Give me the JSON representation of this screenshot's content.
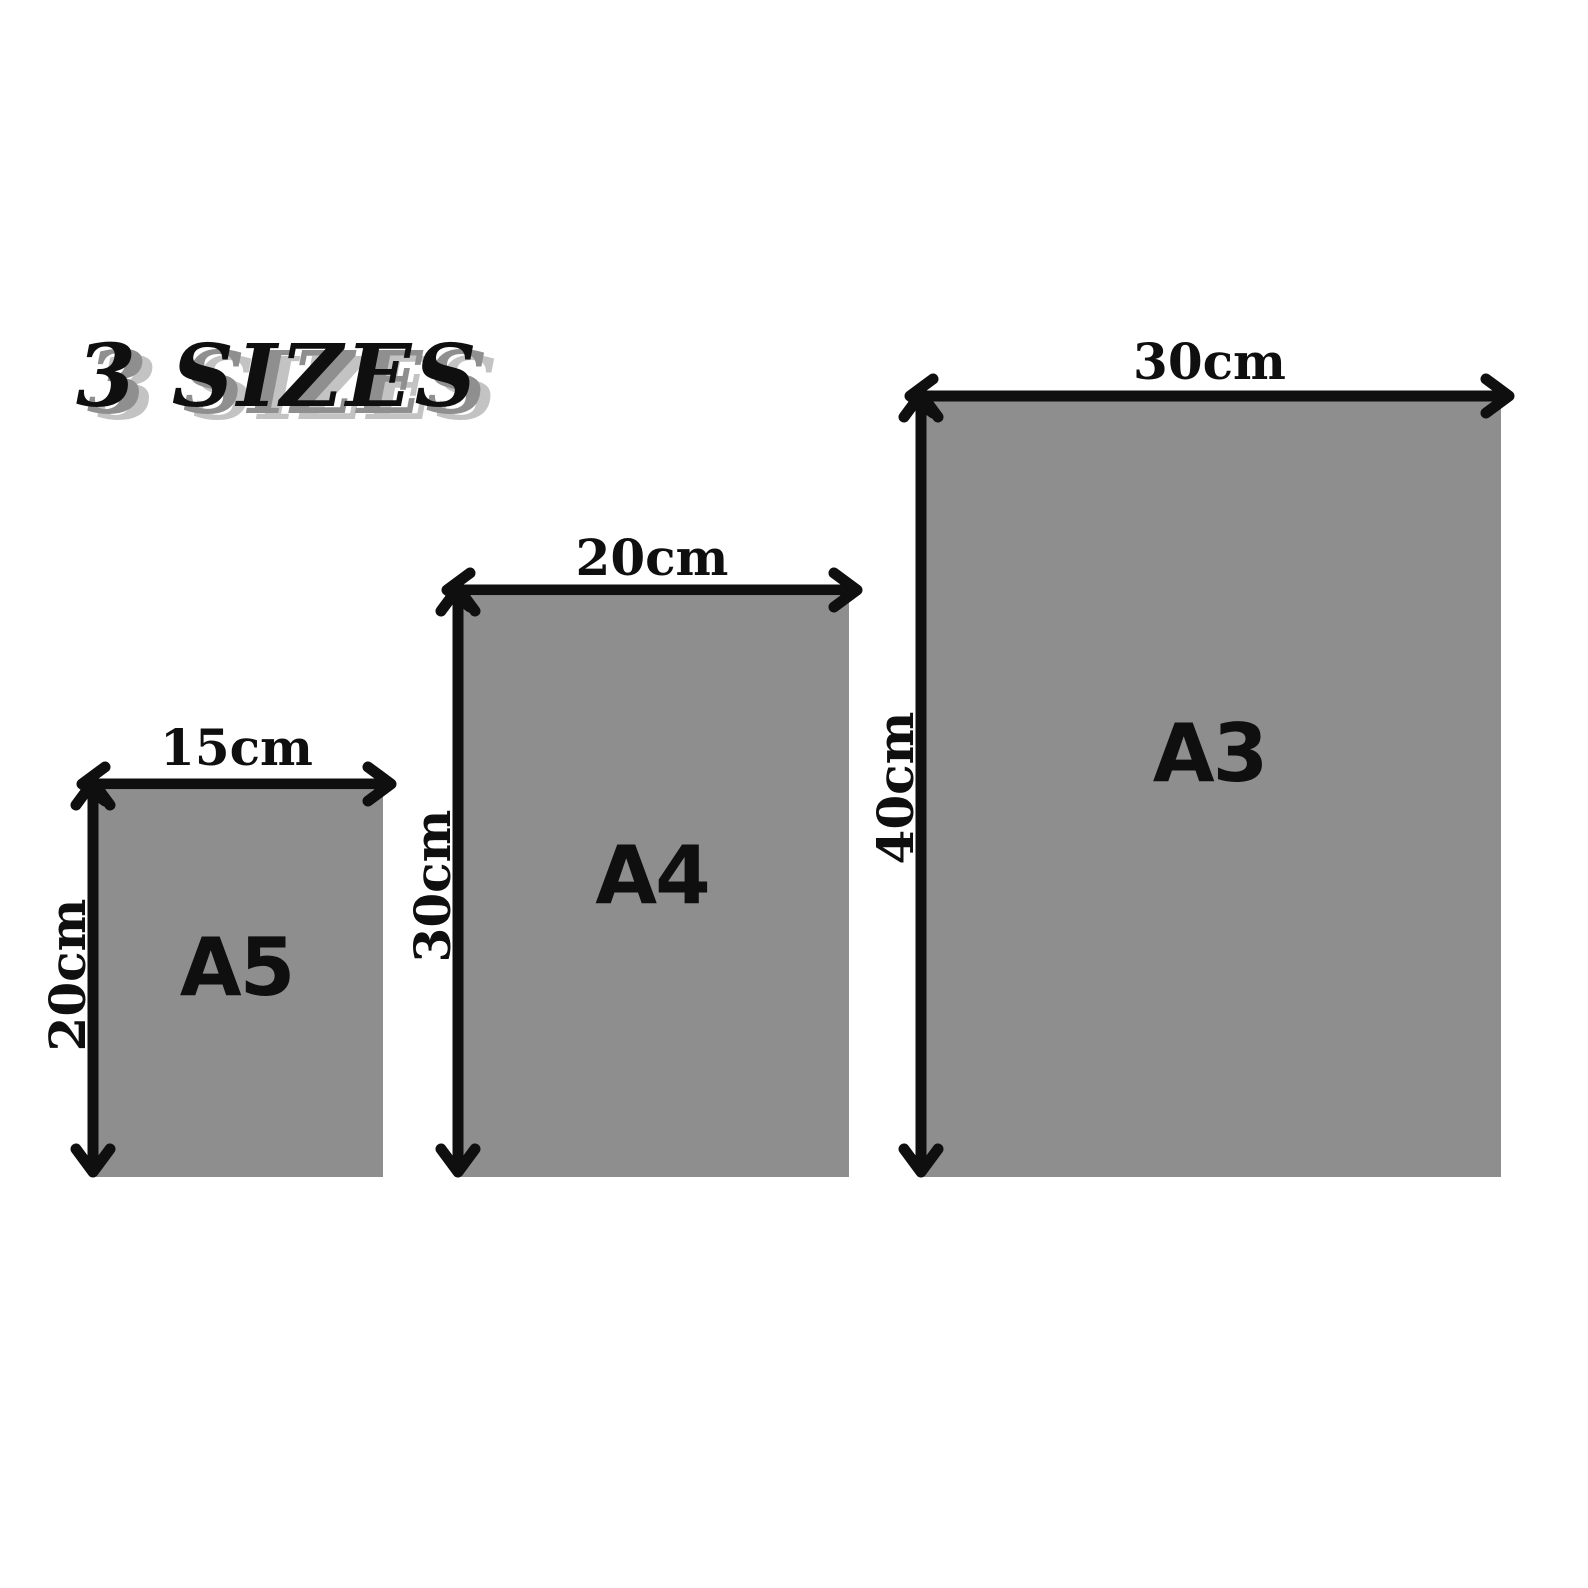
{
  "title": {
    "text": "3 SIZES"
  },
  "colors": {
    "background": "#ffffff",
    "rect_fill": "#8e8e8e",
    "ink": "#0f0f0f",
    "title_shadow_near": "#8f8f8f",
    "title_shadow_far": "#c3c3c3"
  },
  "sizes": [
    {
      "id": "a5",
      "name": "A5",
      "width_cm": 15,
      "height_cm": 20,
      "width_label": "15cm",
      "height_label": "20cm"
    },
    {
      "id": "a4",
      "name": "A4",
      "width_cm": 20,
      "height_cm": 30,
      "width_label": "20cm",
      "height_label": "30cm"
    },
    {
      "id": "a3",
      "name": "A3",
      "width_cm": 30,
      "height_cm": 40,
      "width_label": "30cm",
      "height_label": "40cm"
    }
  ]
}
